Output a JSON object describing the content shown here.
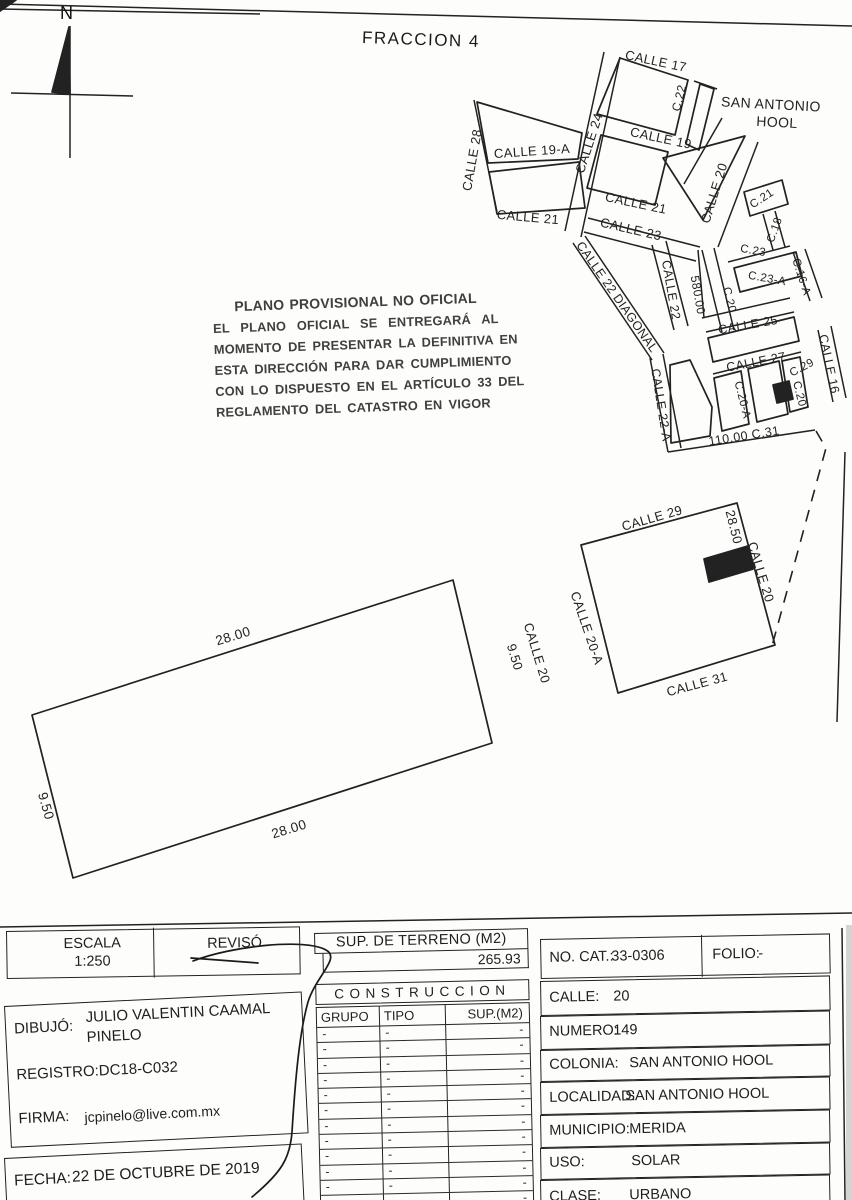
{
  "page": {
    "title": "FRACCION 4",
    "north_label": "N",
    "ink_color": "#222222"
  },
  "stamp": {
    "lines": [
      "PLANO PROVISIONAL NO OFICIAL",
      "EL PLANO OFICIAL SE ENTREGARÁ AL",
      "MOMENTO DE PRESENTAR LA DEFINITIVA EN",
      "ESTA DIRECCIÓN PARA DAR CUMPLIMIENTO",
      "CON LO DISPUESTO EN EL ARTÍCULO 33 DEL",
      "REGLAMENTO DEL CATASTRO EN VIGOR"
    ]
  },
  "map": {
    "labels": [
      {
        "t": "CALLE 17",
        "x": 656,
        "y": 61,
        "r": 12,
        "fs": 13
      },
      {
        "t": "C.22",
        "x": 679,
        "y": 98,
        "r": -76,
        "fs": 12
      },
      {
        "t": "SAN ANTONIO",
        "x": 771,
        "y": 104,
        "r": 3,
        "fs": 14
      },
      {
        "t": "HOOL",
        "x": 777,
        "y": 122,
        "r": 3,
        "fs": 14
      },
      {
        "t": "CALLE 24",
        "x": 589,
        "y": 143,
        "r": -72,
        "fs": 13
      },
      {
        "t": "CALLE 19",
        "x": 661,
        "y": 138,
        "r": 12,
        "fs": 13
      },
      {
        "t": "CALLE 28",
        "x": 472,
        "y": 160,
        "r": -80,
        "fs": 13
      },
      {
        "t": "CALLE 19-A",
        "x": 532,
        "y": 151,
        "r": -4,
        "fs": 13
      },
      {
        "t": "CALLE 20",
        "x": 714,
        "y": 193,
        "r": -73,
        "fs": 13
      },
      {
        "t": "CALLE 21",
        "x": 528,
        "y": 217,
        "r": 5,
        "fs": 13
      },
      {
        "t": "CALLE 21",
        "x": 636,
        "y": 203,
        "r": 12,
        "fs": 13
      },
      {
        "t": "C.21",
        "x": 762,
        "y": 199,
        "r": -33,
        "fs": 11.5
      },
      {
        "t": "CALLE 23",
        "x": 631,
        "y": 229,
        "r": 13,
        "fs": 13
      },
      {
        "t": "C.18",
        "x": 775,
        "y": 230,
        "r": -70,
        "fs": 11.5
      },
      {
        "t": "C.23",
        "x": 753,
        "y": 251,
        "r": 10,
        "fs": 11.5
      },
      {
        "t": "C.23-A",
        "x": 767,
        "y": 279,
        "r": 10,
        "fs": 11.5
      },
      {
        "t": "C.16-A",
        "x": 801,
        "y": 277,
        "r": 72,
        "fs": 11.5
      },
      {
        "t": "C.20",
        "x": 729,
        "y": 300,
        "r": 76,
        "fs": 11.5
      },
      {
        "t": "CALLE 25",
        "x": 748,
        "y": 325,
        "r": -10,
        "fs": 12.5
      },
      {
        "t": "CALLE 22 DIAGONAL",
        "x": 617,
        "y": 297,
        "r": 55,
        "fs": 12.5
      },
      {
        "t": "CALLE 22",
        "x": 671,
        "y": 290,
        "r": 80,
        "fs": 12.5
      },
      {
        "t": "580.00",
        "x": 698,
        "y": 295,
        "r": 80,
        "fs": 12
      },
      {
        "t": "CALLE 22-A",
        "x": 661,
        "y": 405,
        "r": 81,
        "fs": 12.5
      },
      {
        "t": "CALLE 27",
        "x": 756,
        "y": 362,
        "r": -11,
        "fs": 12.5
      },
      {
        "t": "C.29",
        "x": 802,
        "y": 368,
        "r": -28,
        "fs": 11.5
      },
      {
        "t": "CALLE 16",
        "x": 829,
        "y": 364,
        "r": 78,
        "fs": 12.5
      },
      {
        "t": "C.20-A",
        "x": 742,
        "y": 400,
        "r": 76,
        "fs": 11.5
      },
      {
        "t": "C.20",
        "x": 799,
        "y": 394,
        "r": 76,
        "fs": 11.5
      },
      {
        "t": "110.00  C.31",
        "x": 744,
        "y": 436,
        "r": -9,
        "fs": 12.5
      },
      {
        "t": "CALLE 29",
        "x": 652,
        "y": 518,
        "r": -16,
        "fs": 13
      },
      {
        "t": "28.50",
        "x": 734,
        "y": 527,
        "r": 76,
        "fs": 13
      },
      {
        "t": "CALLE 20",
        "x": 761,
        "y": 572,
        "r": 73,
        "fs": 13
      },
      {
        "t": "CALLE 20-A",
        "x": 587,
        "y": 628,
        "r": 71,
        "fs": 13
      },
      {
        "t": "CALLE 31",
        "x": 697,
        "y": 684,
        "r": -15,
        "fs": 13
      },
      {
        "t": "28.00",
        "x": 233,
        "y": 636,
        "r": -17,
        "fs": 13.5
      },
      {
        "t": "28.00",
        "x": 289,
        "y": 829,
        "r": -17,
        "fs": 13.5
      },
      {
        "t": "9.50",
        "x": 46,
        "y": 806,
        "r": 74,
        "fs": 13.5
      },
      {
        "t": "9.50",
        "x": 515,
        "y": 657,
        "r": 73,
        "fs": 13
      },
      {
        "t": "CALLE 20",
        "x": 537,
        "y": 653,
        "r": 73,
        "fs": 13
      }
    ]
  },
  "titleblock": {
    "escala_label": "ESCALA",
    "escala_value": "1:250",
    "reviso_label": "REVISÓ",
    "sup_terreno_header": "SUP. DE TERRENO (M2)",
    "sup_terreno_value": "265.93",
    "construccion_title": "CONSTRUCCION",
    "construccion_columns": [
      "GRUPO",
      "TIPO",
      "SUP.(M2)"
    ],
    "construccion_rows": [
      [
        "-",
        "-",
        "-"
      ],
      [
        "-",
        "-",
        "-"
      ],
      [
        "-",
        "-",
        "-"
      ],
      [
        "-",
        "-",
        "-"
      ],
      [
        "-",
        "-",
        "-"
      ],
      [
        "-",
        "-",
        "-"
      ],
      [
        "-",
        "-",
        "-"
      ],
      [
        "-",
        "-",
        "-"
      ],
      [
        "-",
        "-",
        "-"
      ],
      [
        "-",
        "-",
        "-"
      ],
      [
        "-",
        "-",
        "-"
      ],
      [
        "-",
        "-",
        "-"
      ]
    ],
    "dibujo_label": "DIBUJÓ:",
    "dibujo_name_line1": "JULIO VALENTIN CAAMAL",
    "dibujo_name_line2": "PINELO",
    "registro_text": "REGISTRO:DC18-C032",
    "firma_label": "FIRMA:",
    "firma_value": "jcpinelo@live.com.mx",
    "fecha_label": "FECHA:",
    "fecha_value": "22 DE OCTUBRE DE 2019",
    "info_rows": [
      {
        "label": "NO. CAT.:",
        "value": "33-0306",
        "y": 939,
        "h": 38,
        "vx": 70,
        "extra": {
          "label": "FOLIO:",
          "value": "-",
          "x": 160,
          "vx": 56
        }
      },
      {
        "label": "CALLE:",
        "value": "20",
        "y": 981,
        "h": 33,
        "vx": 72
      },
      {
        "label": "NUMERO:",
        "value": "149",
        "y": 1016,
        "h": 32,
        "vx": 72
      },
      {
        "label": "COLONIA:",
        "value": "SAN ANTONIO HOOL",
        "y": 1050,
        "h": 30,
        "vx": 88
      },
      {
        "label": "LOCALIDAD:",
        "value": "SAN ANTONIO HOOL",
        "y": 1082,
        "h": 31,
        "vx": 84
      },
      {
        "label": "MUNICIPIO:",
        "value": "MERIDA",
        "y": 1115,
        "h": 31,
        "vx": 88
      },
      {
        "label": "USO:",
        "value": "SOLAR",
        "y": 1148,
        "h": 30,
        "vx": 90
      },
      {
        "label": "CLASE:",
        "value": "URBANO",
        "y": 1180,
        "h": 34,
        "vx": 88
      }
    ]
  },
  "drawing": {
    "ink": "#222222",
    "lines": [
      [
        0,
        4,
        852,
        26
      ],
      [
        0,
        9,
        260,
        14
      ],
      [
        70,
        26,
        70,
        158
      ],
      [
        11,
        93,
        133,
        96
      ],
      [
        474,
        100,
        497,
        212
      ],
      [
        604,
        52,
        565,
        231
      ],
      [
        620,
        57,
        581,
        237
      ],
      [
        694,
        81,
        717,
        89
      ],
      [
        758,
        142,
        718,
        247
      ],
      [
        588,
        218,
        700,
        247
      ],
      [
        584,
        232,
        696,
        261
      ],
      [
        573,
        243,
        652,
        360
      ],
      [
        585,
        236,
        664,
        353
      ],
      [
        652,
        245,
        674,
        330
      ],
      [
        666,
        241,
        688,
        326
      ],
      [
        702,
        250,
        722,
        332
      ],
      [
        714,
        248,
        734,
        330
      ],
      [
        728,
        262,
        790,
        246
      ],
      [
        763,
        214,
        773,
        250
      ],
      [
        775,
        211,
        785,
        247
      ],
      [
        793,
        252,
        810,
        301
      ],
      [
        805,
        249,
        822,
        298
      ],
      [
        702,
        318,
        790,
        298
      ],
      [
        706,
        332,
        794,
        312
      ],
      [
        698,
        250,
        704,
        318
      ],
      [
        713,
        374,
        801,
        352
      ],
      [
        818,
        330,
        833,
        402
      ],
      [
        831,
        326,
        846,
        398
      ],
      [
        668,
        452,
        815,
        430
      ],
      [
        650,
        358,
        668,
        452
      ],
      [
        663,
        354,
        681,
        448
      ],
      [
        722,
        118,
        684,
        184
      ],
      [
        845,
        452,
        837,
        722
      ],
      [
        842,
        928,
        845,
        1200
      ],
      [
        0,
        927,
        852,
        913
      ]
    ],
    "polygons": [
      {
        "pts": "477,102 582,133 578,159 488,163"
      },
      {
        "pts": "489,172 579,162 585,208 497,214"
      },
      {
        "pts": "620,58 688,80 675,135 597,114"
      },
      {
        "pts": "700,84 714,89 699,150 686,144"
      },
      {
        "pts": "601,135 668,152 655,205 587,188"
      },
      {
        "pts": "663,158 745,136 703,220"
      },
      {
        "pts": "744,192 782,180 788,204 750,216"
      },
      {
        "pts": "734,268 796,252 802,276 740,292"
      },
      {
        "pts": "708,338 794,317 799,341 713,362"
      },
      {
        "pts": "714,378 741,371 749,424 722,431"
      },
      {
        "pts": "748,369 779,361 788,414 757,422"
      },
      {
        "pts": "782,361 800,357 808,407 790,412"
      },
      {
        "pts": "670,365 690,360 712,407 710,436 671,443"
      },
      {
        "pts": "581,545 737,503 775,645 618,693"
      },
      {
        "pts": "32,715 453,580 492,743 73,878"
      },
      {
        "pts": "773,385 789,381 793,399 777,403",
        "fill": true
      },
      {
        "pts": "704,559 748,546 753,569 709,582",
        "fill": true
      },
      {
        "pts": "69,27 52,92 70,94",
        "fill": true
      },
      {
        "pts": "0,0 16,0 0,11",
        "fill": true
      }
    ],
    "dashed": "816,431 826,448 772,646",
    "signature": [
      "M193,961 C232,946 305,938 326,950 C341,958 316,976 308,1002 C299,1034 295,1084 292,1132 C290,1158 282,1172 252,1197",
      "M191,958 L258,963"
    ]
  }
}
